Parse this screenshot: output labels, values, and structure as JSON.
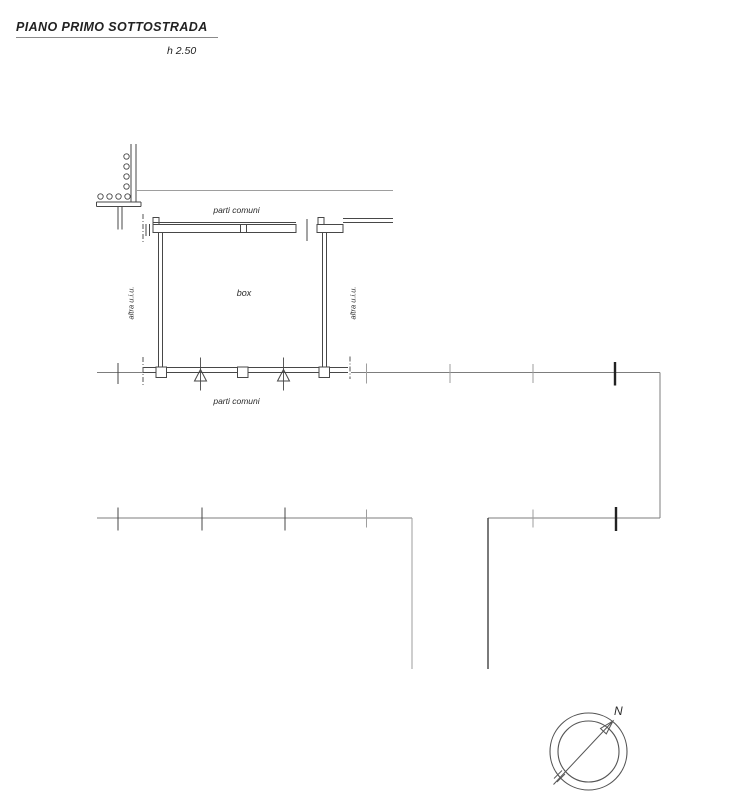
{
  "document": {
    "title": "PIANO PRIMO SOTTOSTRADA",
    "height_note": "h 2.50"
  },
  "plan": {
    "room_label": "box",
    "top_common_label": "parti comuni",
    "bottom_common_label": "parti comuni",
    "left_adjacent_label": "altra u.i.u.",
    "right_adjacent_label": "altra u.i.u."
  },
  "compass": {
    "north_label": "N"
  },
  "colors": {
    "background": "#ffffff",
    "line_dark": "#474747",
    "line_medium": "#7d7d7d",
    "line_light": "#9e9e9e",
    "line_bold": "#222222",
    "text": "#2a2a2a"
  }
}
